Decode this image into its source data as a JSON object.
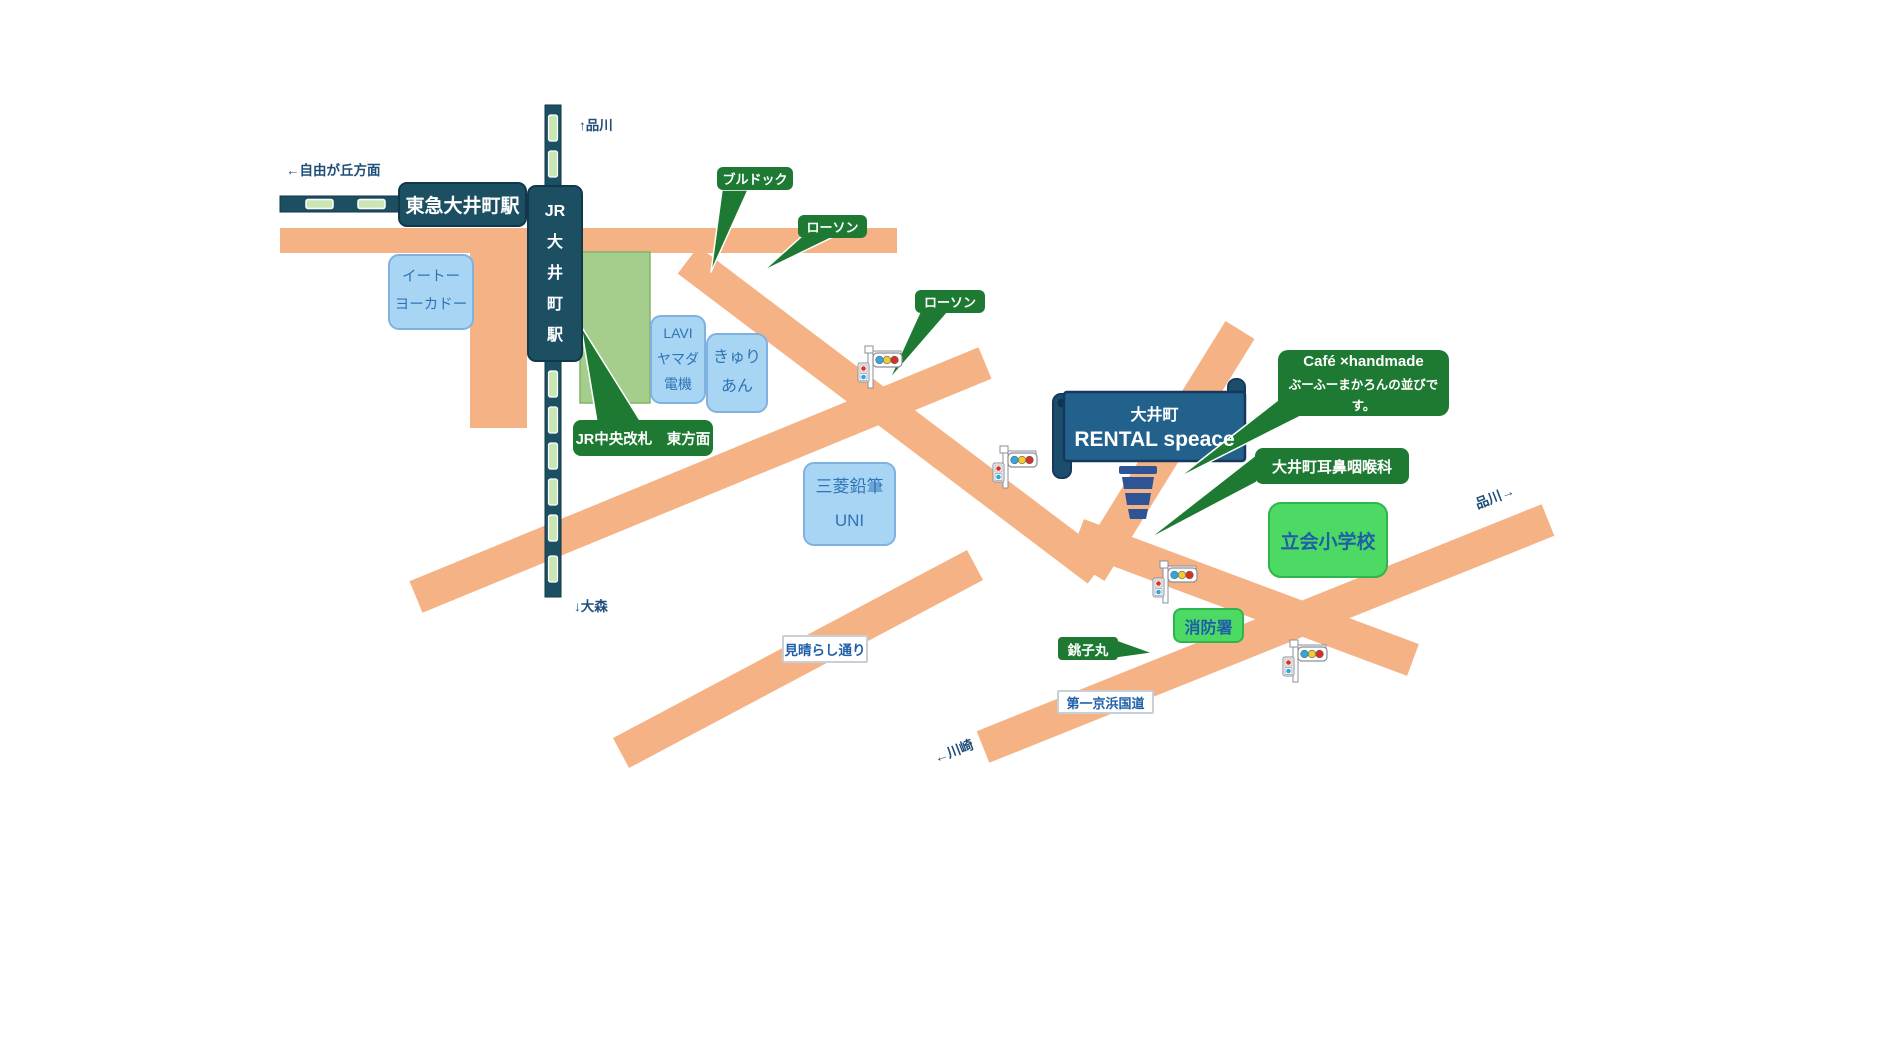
{
  "map": {
    "title": "大井町 RENTAL speace 案内図",
    "stations": {
      "tokyu": "東急大井町駅",
      "jr": "JR\n大\n井\n町\n駅"
    },
    "buildings": {
      "ito_yokado": "イートー\nヨーカドー",
      "lavi": "LAVI\nヤマダ\n電機",
      "kyurian": "きゅり\nあん",
      "uni": "三菱鉛筆\nUNI"
    },
    "callouts": {
      "kaisatsu": "JR中央改札　東方面",
      "bulldog": "ブルドック",
      "lawson1": "ローソン",
      "lawson2": "ローソン",
      "cafe_line1": "Café ×handmade",
      "cafe_line2": "ぶーふーまかろんの並びです。",
      "jibika": "大井町耳鼻咽喉科",
      "choshimaru": "銚子丸"
    },
    "facilities": {
      "school": "立会小学校",
      "fire_station": "消防署"
    },
    "road_labels": {
      "miharashi": "見晴らし通り",
      "keihin": "第一京浜国道"
    },
    "directions": {
      "jiyugaoka": "←自由が丘方面",
      "shinagawa_up": "↑品川",
      "omori": "↓大森",
      "shinagawa_right": "品川→",
      "kawasaki": "←川崎"
    },
    "destination": {
      "line1": "大井町",
      "line2": "RENTAL speace"
    },
    "colors": {
      "road": "#F5B285",
      "station_navy": "#1D4F63",
      "banner_blue": "#21618C",
      "callout_green": "#1E7A32",
      "facility_green": "#4CDA64",
      "building_blue": "#A9D5F5",
      "station_block_green": "#A5CE8D",
      "rail_dash_green": "#CBE6B5",
      "label_text_blue": "#1F5FA8",
      "direction_text_blue": "#1F4E79",
      "cup_blue": "#2F5496"
    },
    "icons": {
      "traffic_signal_count": "4"
    }
  }
}
